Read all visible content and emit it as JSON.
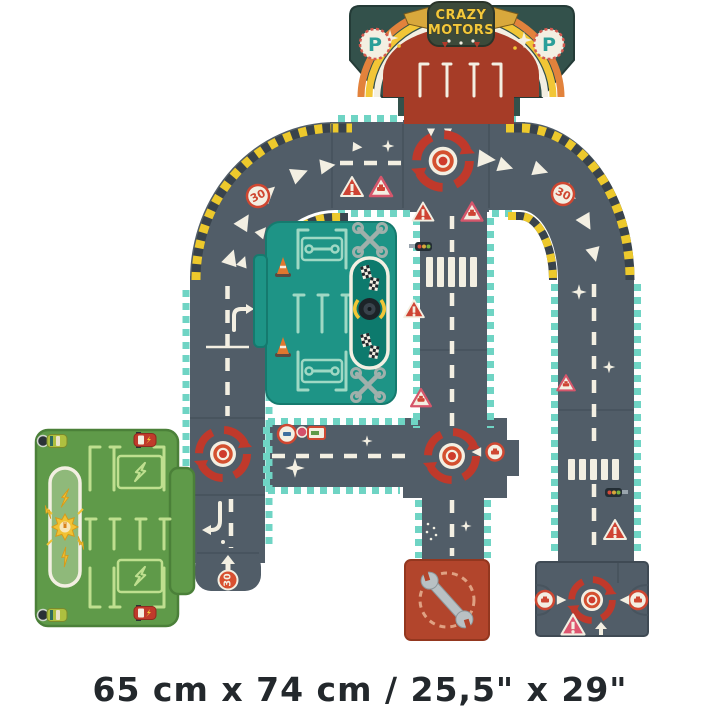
{
  "caption": "65 cm x 74 cm / 25,5\" x 29\"",
  "branding": {
    "logo_line1": "CRAZY",
    "logo_line2": "MOTORS"
  },
  "signs": {
    "parking_letter": "P",
    "speed_limit": "30"
  },
  "colors": {
    "background": "#ffffff",
    "road": "#515d68",
    "road_seam": "#46525c",
    "marking_cream": "#f3efe2",
    "edge_teal": "#6fd4c4",
    "hazard_yellow": "#edc92c",
    "hazard_dark": "#39434c",
    "roundabout_red": "#c0392b",
    "sign_red": "#cf4731",
    "sign_pink": "#de5670",
    "garage_shell_green": "#33514b",
    "garage_interior_red": "#a63c27",
    "rainbow_yellow": "#f2c636",
    "rainbow_orange": "#e2823c",
    "logo_yellow": "#f2c93c",
    "parking_p_teal": "#2b9f99",
    "repair_garage_teal": "#1e9486",
    "repair_garage_lines": "#9fd8c4",
    "charging_green": "#5f9a49",
    "charging_lines": "#bfdf8f",
    "sun_yellow": "#f2c233",
    "service_red": "#b2452c",
    "wrench_gray": "#9fb0ab",
    "cone_orange": "#e0772f",
    "tire_black": "#1c2328",
    "caption_text": "#23282c"
  },
  "icons": {
    "brand-badge": "winged shield logo",
    "parking-sign": "letter P in dotted circle",
    "rainbow-arch": "striped arch",
    "roundabout-icon": "red circular arrows with center dot",
    "speed-limit-sign": "30 in circle",
    "warning-sign-icon": "exclamation triangle",
    "car-warning-sign-icon": "car in triangle",
    "traffic-light-icon": "three-light signal",
    "crosswalk": "white bars",
    "direction-arrow": "white triangle",
    "sparkle": "four-point star",
    "crossed-wrenches-icon": "two crossed wrenches",
    "wrench-icon": "open-end wrench",
    "traffic-cone-icon": "striped cone",
    "checkered-flag-icon": "racing flag",
    "tire-icon": "black tire with flames",
    "charging-sun-icon": "sun with electric plug",
    "lightning-bolt-icon": "lightning bolt",
    "toy-car-icon": "top view toy car"
  }
}
